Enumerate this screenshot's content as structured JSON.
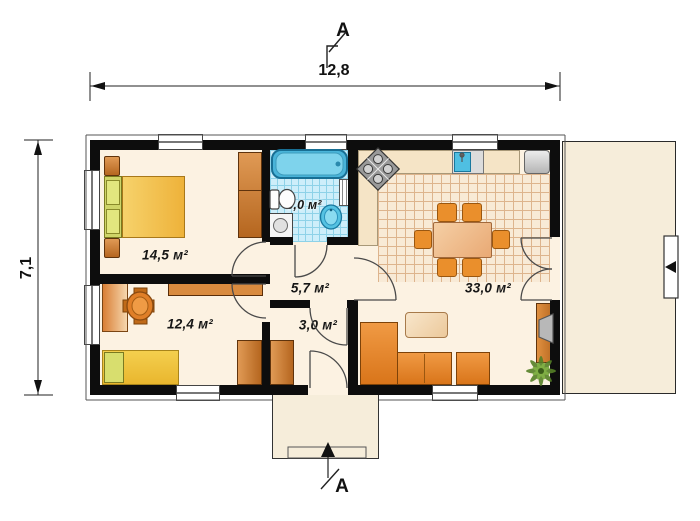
{
  "dimensions": {
    "width": "12,8",
    "height": "7,1"
  },
  "section": {
    "top": "A",
    "bottom": "A"
  },
  "rooms": {
    "bedroom1": {
      "label": "14,5 м²"
    },
    "bathroom": {
      "label": "5,0 м²"
    },
    "bedroom2": {
      "label": "12,4 м²"
    },
    "hallway": {
      "label": "5,7 м²"
    },
    "vestibule": {
      "label": "3,0 м²"
    },
    "living_kitchen": {
      "label": "33,0 м²"
    }
  },
  "colors": {
    "wall": "#0d0d0d",
    "floor": "#fcf2e2",
    "bathroom_tile": "#cdeefa",
    "kitchen_tile": "#f8ead6",
    "terrace": "#f6edda",
    "furniture_orange": "#e8882a",
    "wood": "#cd8040",
    "water_blue": "#4fbfe2",
    "bed_yellow": "#eeb23a"
  }
}
